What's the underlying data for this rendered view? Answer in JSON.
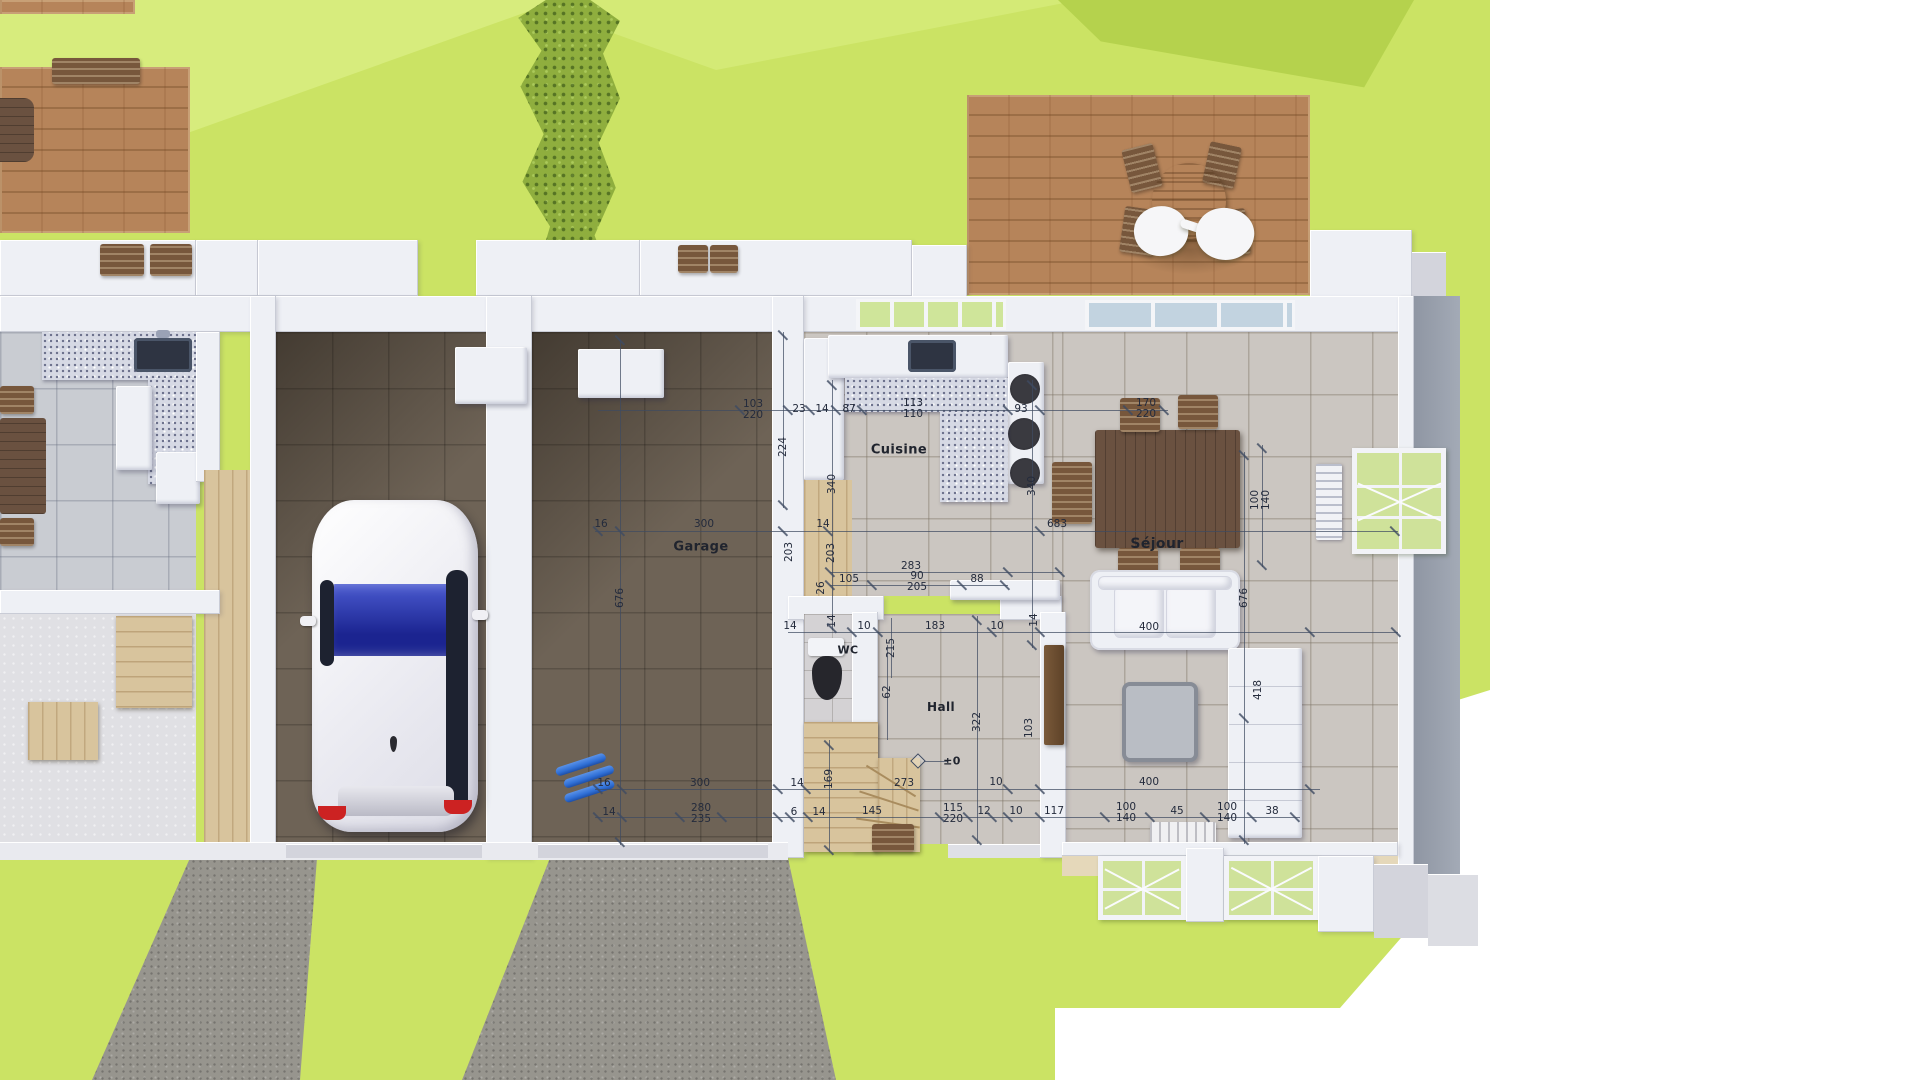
{
  "room_labels": [
    {
      "text": "Garage",
      "x": 701,
      "y": 547,
      "size": 13
    },
    {
      "text": "Cuisine",
      "x": 899,
      "y": 450,
      "size": 13
    },
    {
      "text": "Séjour",
      "x": 1157,
      "y": 544,
      "size": 14
    },
    {
      "text": "Hall",
      "x": 941,
      "y": 707,
      "size": 12
    },
    {
      "text": "WC",
      "x": 848,
      "y": 650,
      "size": 11
    },
    {
      "text": "±0",
      "x": 952,
      "y": 761,
      "size": 11
    }
  ],
  "dimensions": [
    {
      "t": "103",
      "x": 753,
      "y": 404
    },
    {
      "t": "220",
      "x": 753,
      "y": 415
    },
    {
      "t": "23",
      "x": 799,
      "y": 409
    },
    {
      "t": "14",
      "x": 822,
      "y": 409
    },
    {
      "t": "87",
      "x": 849,
      "y": 409
    },
    {
      "t": "113",
      "x": 913,
      "y": 403
    },
    {
      "t": "110",
      "x": 913,
      "y": 414
    },
    {
      "t": "93",
      "x": 1021,
      "y": 409
    },
    {
      "t": "170",
      "x": 1146,
      "y": 403
    },
    {
      "t": "220",
      "x": 1146,
      "y": 414
    },
    {
      "t": "16",
      "x": 601,
      "y": 524
    },
    {
      "t": "300",
      "x": 704,
      "y": 524
    },
    {
      "t": "14",
      "x": 823,
      "y": 524
    },
    {
      "t": "683",
      "x": 1057,
      "y": 524
    },
    {
      "t": "283",
      "x": 911,
      "y": 566
    },
    {
      "t": "105",
      "x": 849,
      "y": 579
    },
    {
      "t": "90",
      "x": 917,
      "y": 576
    },
    {
      "t": "205",
      "x": 917,
      "y": 587
    },
    {
      "t": "88",
      "x": 977,
      "y": 579
    },
    {
      "t": "14",
      "x": 790,
      "y": 626
    },
    {
      "t": "10",
      "x": 864,
      "y": 626
    },
    {
      "t": "183",
      "x": 935,
      "y": 626
    },
    {
      "t": "10",
      "x": 997,
      "y": 626
    },
    {
      "t": "400",
      "x": 1149,
      "y": 627
    },
    {
      "t": "16",
      "x": 604,
      "y": 783
    },
    {
      "t": "300",
      "x": 700,
      "y": 783
    },
    {
      "t": "14",
      "x": 797,
      "y": 783
    },
    {
      "t": "273",
      "x": 904,
      "y": 783
    },
    {
      "t": "10",
      "x": 996,
      "y": 782
    },
    {
      "t": "400",
      "x": 1149,
      "y": 782
    },
    {
      "t": "14",
      "x": 609,
      "y": 812
    },
    {
      "t": "280",
      "x": 701,
      "y": 808
    },
    {
      "t": "235",
      "x": 701,
      "y": 819
    },
    {
      "t": "6",
      "x": 794,
      "y": 812
    },
    {
      "t": "14",
      "x": 819,
      "y": 812
    },
    {
      "t": "145",
      "x": 872,
      "y": 811
    },
    {
      "t": "115",
      "x": 953,
      "y": 808
    },
    {
      "t": "220",
      "x": 953,
      "y": 819
    },
    {
      "t": "12",
      "x": 984,
      "y": 811
    },
    {
      "t": "10",
      "x": 1016,
      "y": 811
    },
    {
      "t": "117",
      "x": 1054,
      "y": 811
    },
    {
      "t": "100",
      "x": 1126,
      "y": 807
    },
    {
      "t": "140",
      "x": 1126,
      "y": 818
    },
    {
      "t": "45",
      "x": 1177,
      "y": 811
    },
    {
      "t": "100",
      "x": 1227,
      "y": 807
    },
    {
      "t": "140",
      "x": 1227,
      "y": 818
    },
    {
      "t": "38",
      "x": 1272,
      "y": 811
    },
    {
      "t": "676",
      "x": 620,
      "y": 598,
      "v": 1
    },
    {
      "t": "224",
      "x": 783,
      "y": 447,
      "v": 1
    },
    {
      "t": "340",
      "x": 832,
      "y": 484,
      "v": 1
    },
    {
      "t": "26",
      "x": 821,
      "y": 588,
      "v": 1
    },
    {
      "t": "14",
      "x": 832,
      "y": 621,
      "v": 1
    },
    {
      "t": "203",
      "x": 789,
      "y": 552,
      "v": 1
    },
    {
      "t": "203",
      "x": 831,
      "y": 553,
      "v": 1
    },
    {
      "t": "215",
      "x": 891,
      "y": 648,
      "v": 1
    },
    {
      "t": "62",
      "x": 887,
      "y": 692,
      "v": 1
    },
    {
      "t": "340",
      "x": 1032,
      "y": 486,
      "v": 1
    },
    {
      "t": "14",
      "x": 1034,
      "y": 620,
      "v": 1
    },
    {
      "t": "322",
      "x": 977,
      "y": 722,
      "v": 1
    },
    {
      "t": "169",
      "x": 829,
      "y": 779,
      "v": 1
    },
    {
      "t": "100",
      "x": 1255,
      "y": 500,
      "v": 1
    },
    {
      "t": "140",
      "x": 1266,
      "y": 500,
      "v": 1
    },
    {
      "t": "676",
      "x": 1244,
      "y": 598,
      "v": 1
    },
    {
      "t": "418",
      "x": 1258,
      "y": 690,
      "v": 1
    },
    {
      "t": "103",
      "x": 1029,
      "y": 728,
      "v": 1
    }
  ],
  "objects": [
    "white-hatchback-car",
    "round-patio-table",
    "patio-chairs",
    "seated-people",
    "wood-deck",
    "dining-table",
    "dining-chairs",
    "white-sofa",
    "coffee-table",
    "sideboard",
    "kitchen-sink",
    "cooktop-burners",
    "kitchen-island",
    "refrigerator",
    "tall-cabinet",
    "wall-cabinets",
    "toilet",
    "winder-staircase",
    "doormat",
    "radiator",
    "french-window",
    "blue-pipes",
    "hedge",
    "driveway",
    "lawn",
    "facade-windows",
    "porch-steps"
  ],
  "colors": {
    "lawn": "#cbe364",
    "lawn_light": "#d7ec7d",
    "lawn_dark": "#b5d24d",
    "deck_wood": "#b6845a",
    "driveway": "#97958e",
    "garage_floor": "#6e6356",
    "tile_floor": "#cbc6c1",
    "wall": "#eef0f5",
    "wall_face": "#9aa1ae",
    "granite": "#d6d9e4",
    "dim_line": "#3f4b61",
    "glass": "#cfe59a",
    "car": "#f2f2f6",
    "windshield": "#2a3bbf",
    "table_wood": "#6a5140",
    "pipe_blue": "#2f6fd6"
  }
}
